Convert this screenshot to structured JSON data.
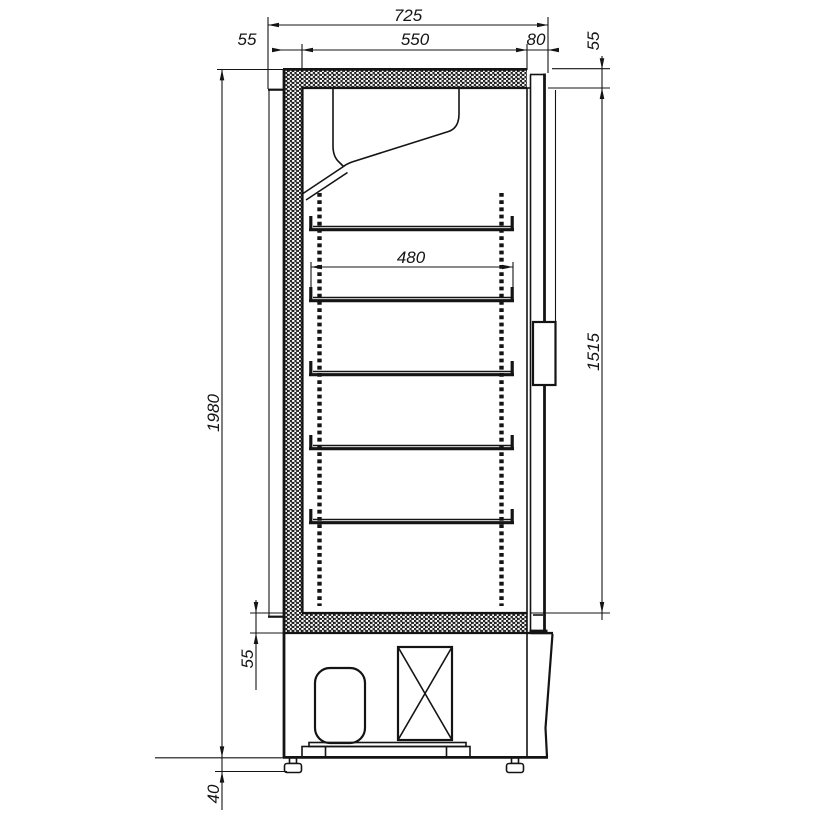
{
  "drawing": {
    "type": "technical-section",
    "subject": "refrigerated display cabinet side section",
    "colors": {
      "line": "#141414",
      "background": "#ffffff"
    },
    "dims": {
      "overall_width": "725",
      "back_wall_thickness": "55",
      "interior_width": "550",
      "door_depth": "80",
      "roof_thickness": "55",
      "overall_height": "1980",
      "shelf_width": "480",
      "interior_height": "1515",
      "floor_thickness": "55",
      "foot_height": "40"
    }
  }
}
